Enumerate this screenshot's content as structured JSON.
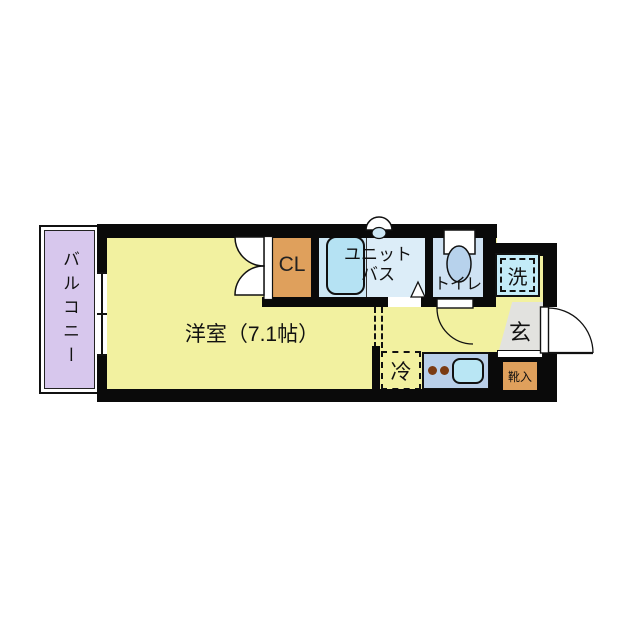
{
  "floorplan": {
    "balcony": {
      "label": "バルコニー"
    },
    "main_room": {
      "label": "洋室（7.1帖）"
    },
    "closet": {
      "label": "CL"
    },
    "unit_bath": {
      "label": "ユニットバス",
      "line1": "ユニット",
      "line2": "バス"
    },
    "toilet": {
      "label": "トイレ"
    },
    "washer": {
      "label": "洗"
    },
    "entrance": {
      "label": "玄"
    },
    "refrigerator": {
      "label": "冷"
    },
    "shoe_box": {
      "label": "靴入"
    }
  },
  "colors": {
    "wall": "#0a0a0a",
    "room_yellow": "#f2f1a0",
    "balcony_purple": "#d7c7ed",
    "closet_orange": "#dfa05c",
    "bath_blue": "#cde7f5",
    "bath_right_blue": "#dcedf8",
    "bathtub_blue": "#b5e2f3",
    "toilet_blue": "#cfe2f3",
    "toilet_bowl_blue": "#b7d2ec",
    "washer_blue": "#c3ebf8",
    "kitchen_counter_blue": "#b9cfe9",
    "sink_blue": "#b9e6f4",
    "genkan_gray": "#e2e2df",
    "burner_brown": "#7b3a12"
  }
}
